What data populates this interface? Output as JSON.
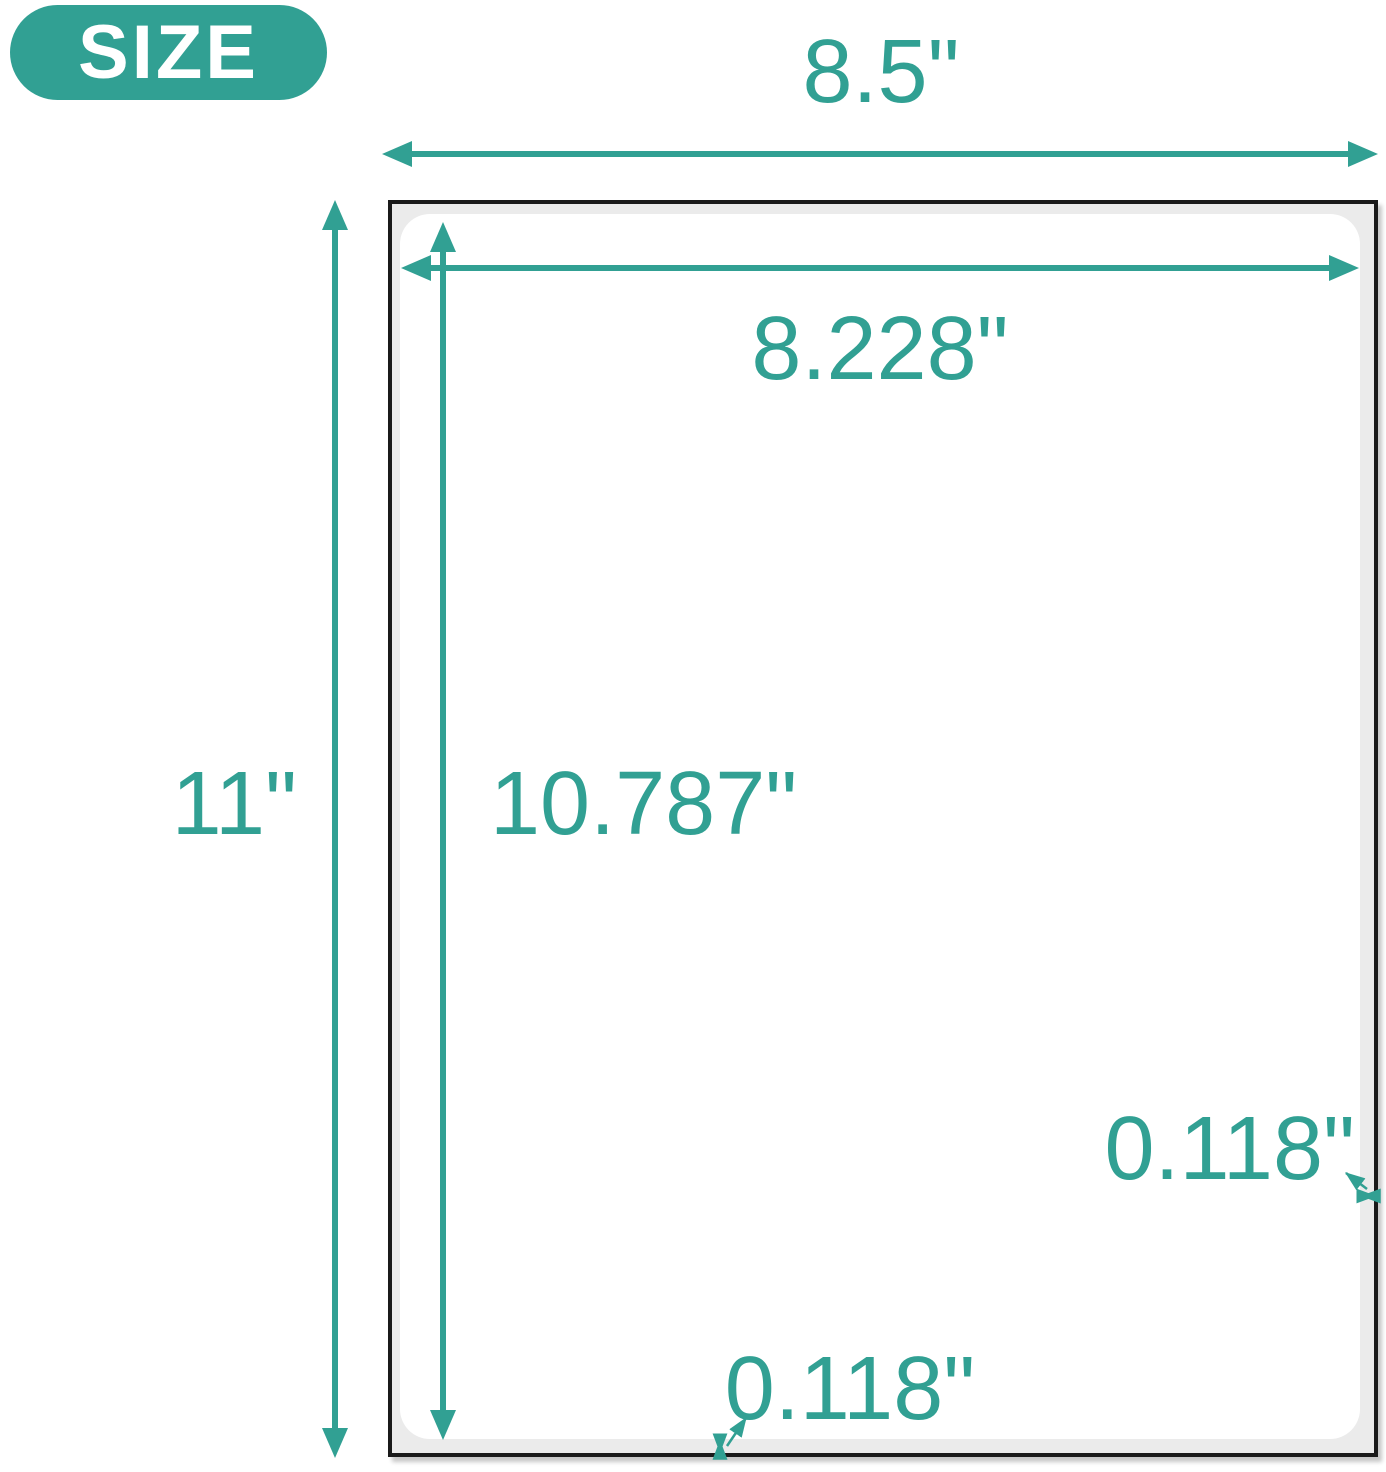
{
  "colors": {
    "accent": "#31A093",
    "sheet_fill": "#EBEBEB",
    "sheet_border": "#1A1A1A"
  },
  "badge": {
    "label": "SIZE"
  },
  "dimensions": {
    "sheet_width": "8.5\"",
    "sheet_height": "11\"",
    "label_width": "8.228\"",
    "label_height": "10.787\"",
    "margin_bottom": "0.118\"",
    "margin_right": "0.118\""
  }
}
